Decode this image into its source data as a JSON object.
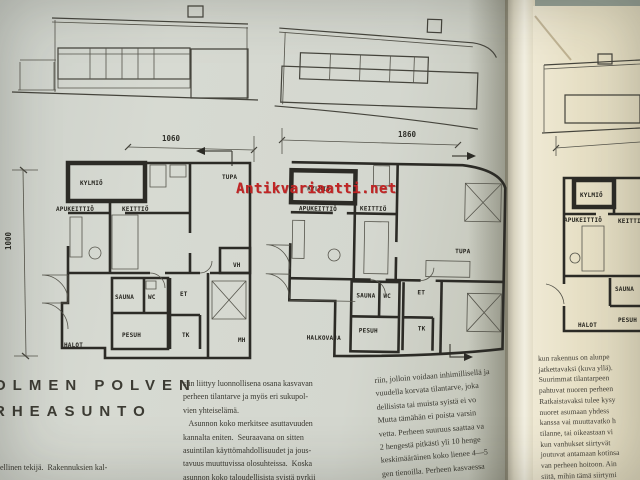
{
  "palette": {
    "left_paper": "#d7dad2",
    "left_paper_edge": "#c2c4b7",
    "right_paper": "#e7e0c6",
    "gutter_light": "#f2efe1",
    "ink": "#3b3a33",
    "wall": "#2c2b26",
    "watermark_red": "#c12424",
    "background": "#95a095"
  },
  "watermark": {
    "text": "Antikvariaatti.net"
  },
  "left_page": {
    "heading_line1": "OLMEN POLVEN",
    "heading_line2": "RHEASUNTO",
    "col1_lines": [
      "dellinen tekijä.  Rakennuksien kal-"
    ],
    "col2_lines": [
      "siin liittyy luonnollisena osana kasvavan",
      "perheen tilantarve ja myös eri sukupol-",
      "vien yhteiselämä.",
      "   Asunnon koko merkitsee asuttavuuden",
      "kannalta eniten.  Seuraavana on sitten",
      "asuintilan käyttömahdollisuudet ja jous-",
      "tavuus muuttuvissa olosuhteissa.  Koska",
      "asunnon koko taloudellisista syistä pyrkii"
    ],
    "col3_lines": [
      "riin, jolloin voidaan inhimillisellä ja",
      "vuudella korvata tilantarve, joka",
      "dellisista tai muista syistä ei vo",
      "Mutta tämähän ei poista varsin",
      "vetta. Perheen suuruus saattaa va",
      "2 hengestä pitkästi yli 10 henge",
      "keskimääräinen koko lienee 4—5",
      "gen tienoilla. Perheen kasvaessa"
    ],
    "plan1": {
      "dim_width": "1060",
      "dim_height": "1000",
      "rooms": {
        "kylmio": "KYLMIÖ",
        "apukeittio": "APUKEITTIÖ",
        "keittio": "KEITTIÖ",
        "tupa": "TUPA",
        "sauna": "SAUNA",
        "wc": "WC",
        "et": "ET",
        "vh": "VH",
        "pesuh": "PESUH",
        "halot": "HALOT",
        "tk": "TK",
        "mh": "MH"
      }
    },
    "plan2": {
      "dim_width": "1860",
      "rooms": {
        "kylmio": "KYLMIÖ",
        "apukeittio": "APUKEITTIÖ",
        "keittio": "KEITTIÖ",
        "tupa": "TUPA",
        "sauna": "SAUNA",
        "wc": "WC",
        "et": "ET",
        "pesuh": "PESUH",
        "halkovaja": "HALKOVAJA",
        "tk": "TK"
      }
    }
  },
  "right_page": {
    "plan3": {
      "rooms": {
        "kylmio": "KYLMIÖ",
        "apukeittio": "APUKEITTIÖ",
        "keittio": "KEITTIÖ",
        "sauna": "SAUNA",
        "halot": "HALOT",
        "pesuh": "PESUH"
      }
    },
    "text_lines": [
      "kun rakennus on alunpe",
      "jatkettavaksi (kuva yllä).",
      "Suurimmat tilantarpeen",
      "pahtuvat nuoren perheen",
      "Ratkaistavaksi tulee kysy",
      "nuoret asumaan yhdess",
      "kanssa vai muuttavatko h",
      "tilanne, tai oikeastaan vi",
      "kun vanhukset siirtyvät",
      "joutuvat antamaan kotinsa",
      "van perheen hoitoon. Ain",
      "siitä, mihin tämä siirtymi"
    ]
  }
}
